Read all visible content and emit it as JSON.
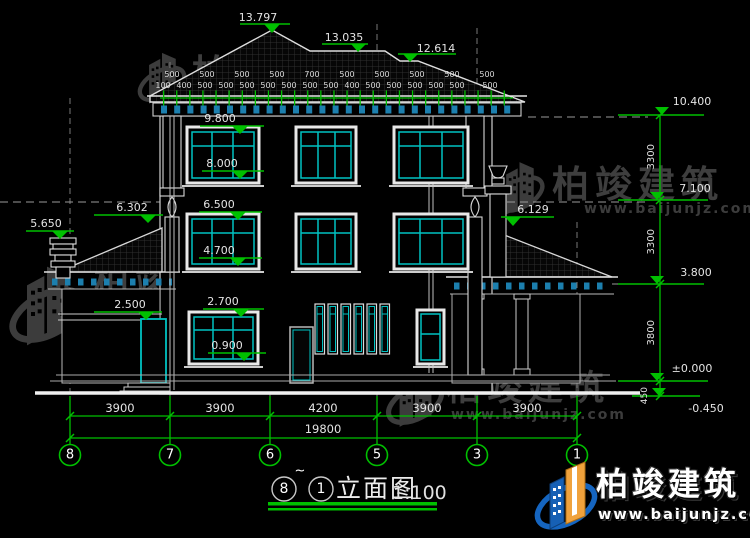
{
  "watermark": {
    "brand": "柏竣建筑",
    "url": "www.baijunjz.com"
  },
  "footer": {
    "brand": "柏竣建筑",
    "url": "www.baijunjz.com"
  },
  "title": {
    "from": "8",
    "tilde": "~",
    "to": "1",
    "text": "立面图",
    "scale": "1:100"
  },
  "top_levels": {
    "peak": "13.797",
    "mid": "13.035",
    "low": "12.614"
  },
  "eave_dims": {
    "row1": [
      "500",
      "500",
      "500",
      "500",
      "700",
      "500",
      "500",
      "500",
      "500",
      "500"
    ],
    "row2": [
      "100",
      "400",
      "500",
      "500",
      "500",
      "500",
      "500",
      "500",
      "500",
      "400",
      "500",
      "500",
      "500",
      "500",
      "500",
      "500"
    ]
  },
  "left_levels": {
    "win3_top": "9.800",
    "win3_sill": "8.000",
    "win2_top": "6.500",
    "win2_sill": "4.700",
    "win1_top": "2.700",
    "win1_sill": "0.900",
    "porch_roof": "6.302",
    "chimney": "5.650",
    "porch_beam": "2.500"
  },
  "right_levels": {
    "eave": "10.400",
    "mid": "7.100",
    "wing_roof": "6.129",
    "wing_eave": "3.800",
    "floor": "±0.000",
    "ground": "-0.450"
  },
  "right_vdims": [
    "3300",
    "3300",
    "3800",
    "450"
  ],
  "bottom_dims": {
    "segments": [
      "3900",
      "3900",
      "4200",
      "3900",
      "3900"
    ],
    "total": "19800"
  },
  "grid_bubbles": [
    "8",
    "7",
    "6",
    "5",
    "3",
    "1"
  ]
}
